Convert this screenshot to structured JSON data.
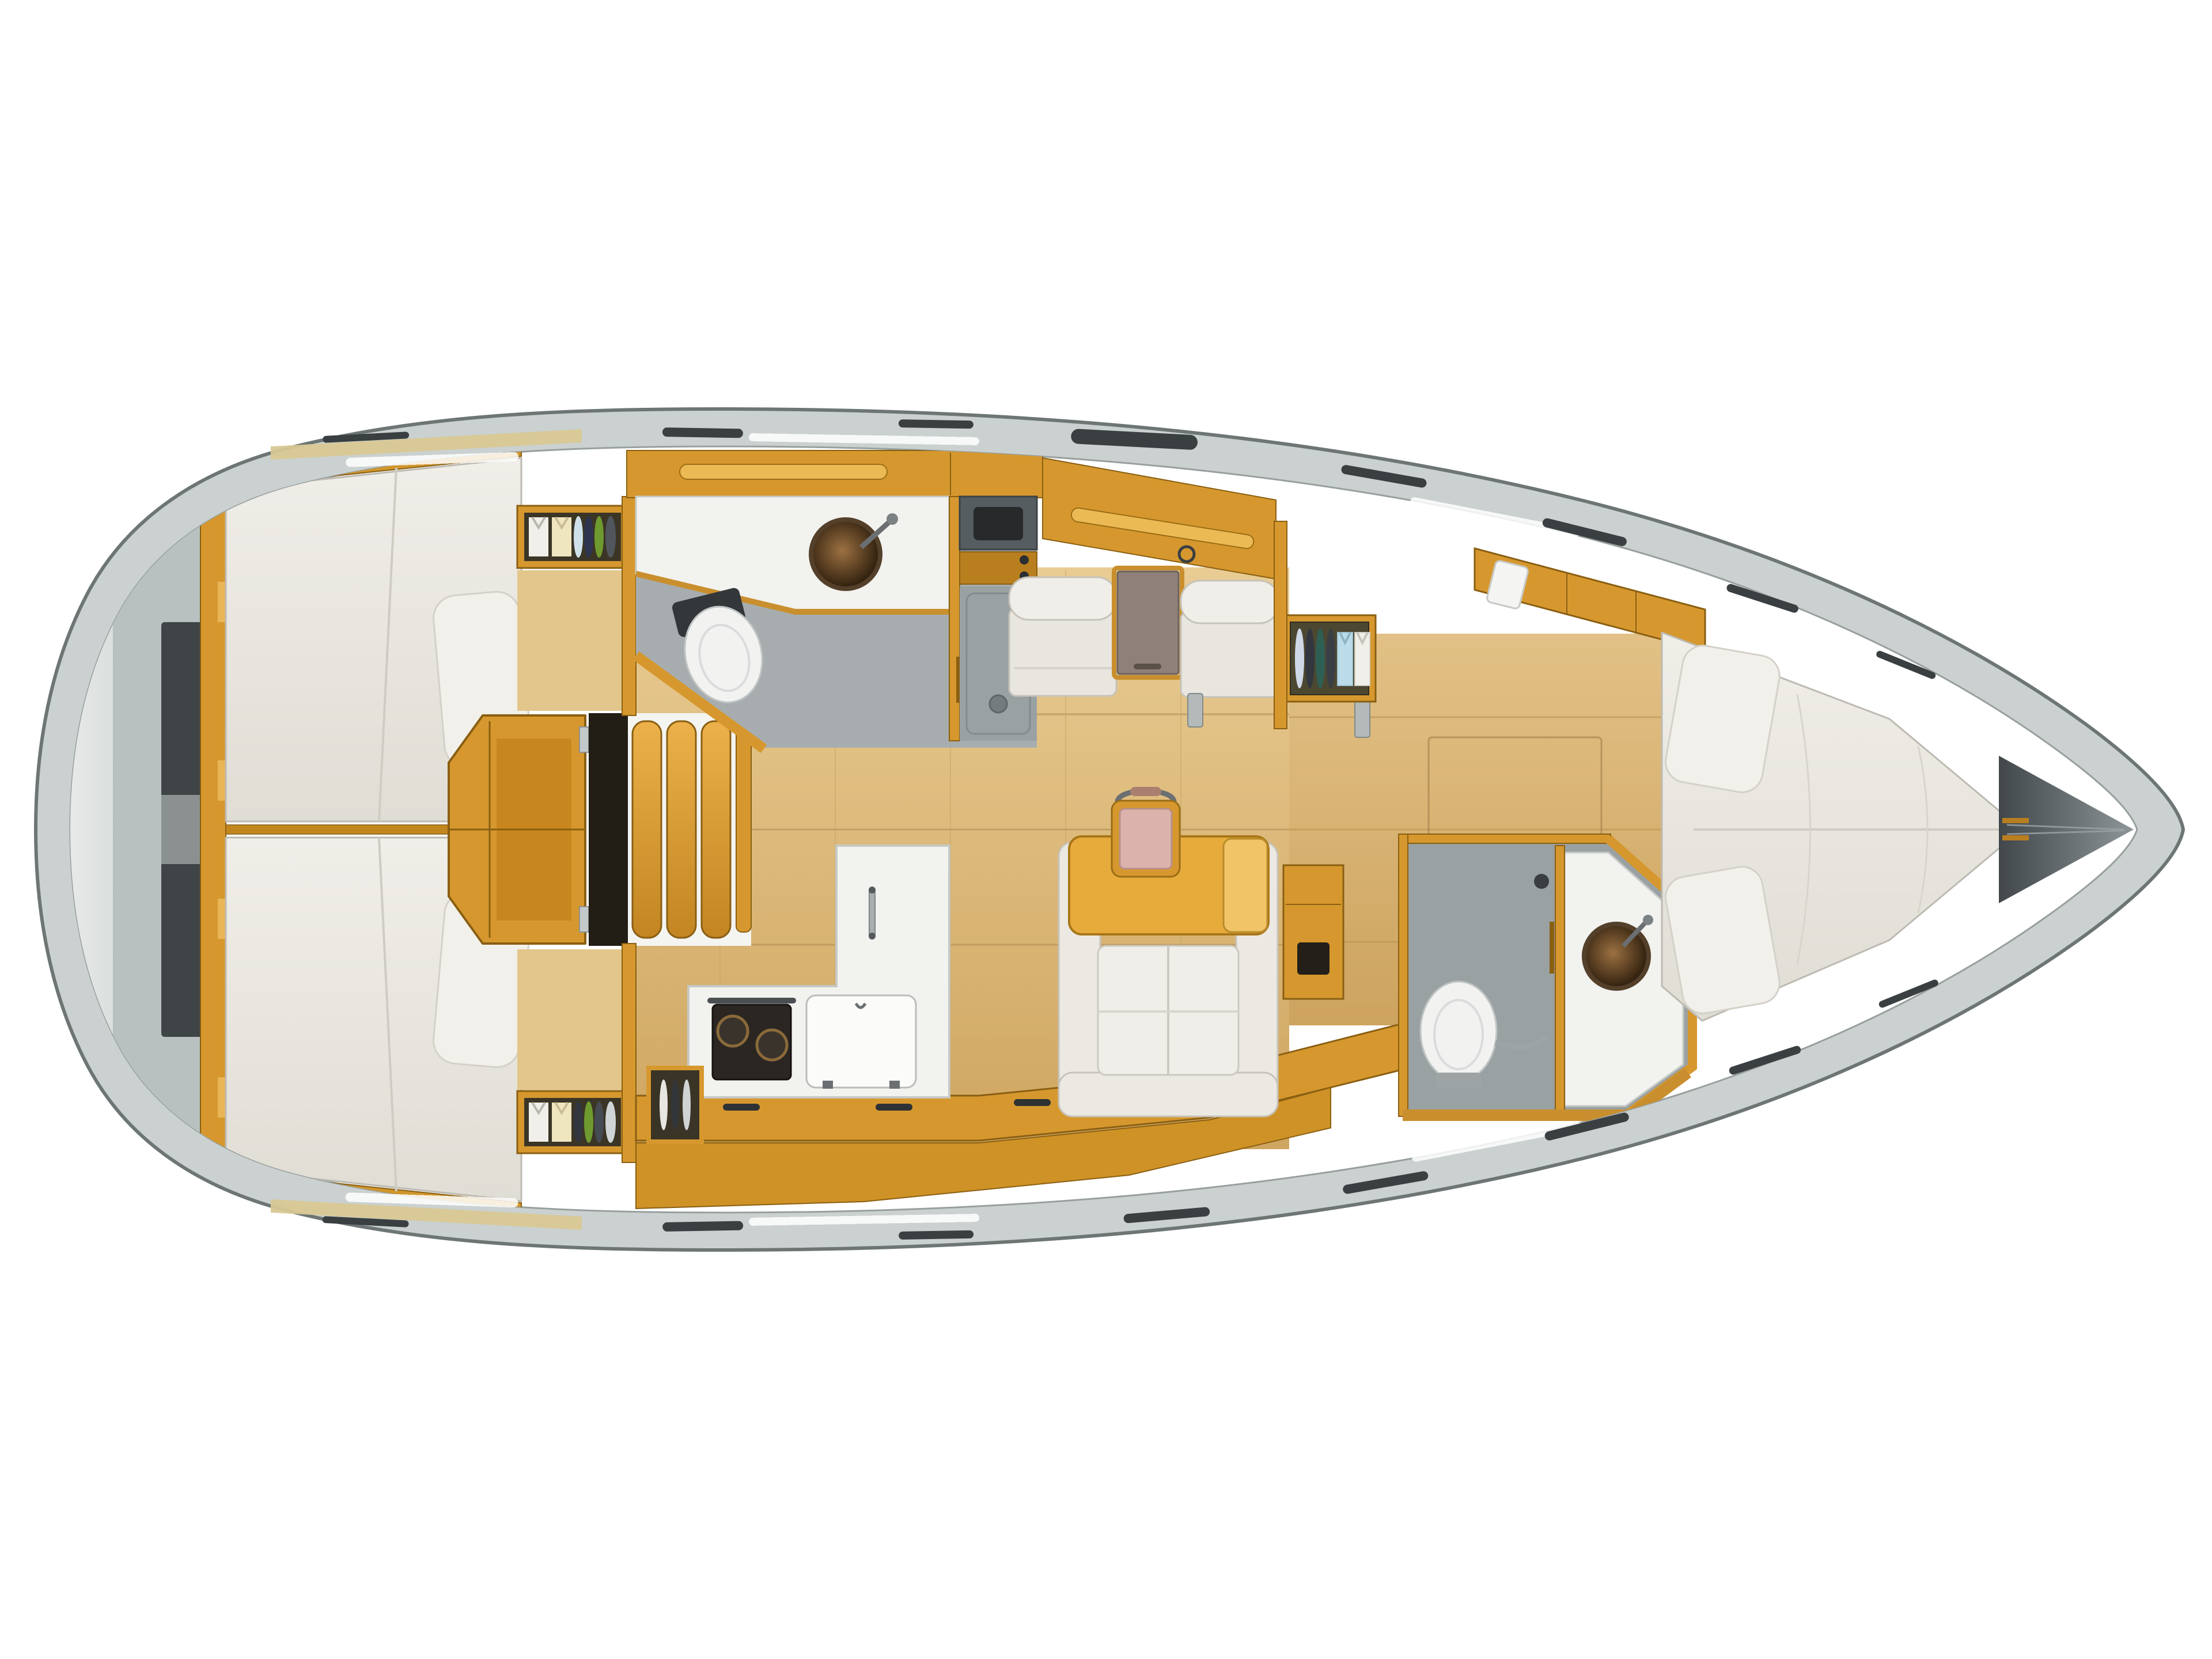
{
  "meta": {
    "title": "sailboat-interior-floor-plan",
    "view": "top-down-3d-render",
    "visible_text": "none"
  },
  "colors": {
    "background": "#ffffff",
    "hull_outline": "#6d7575",
    "deck_band": "#cbd1d0",
    "stern_gray_light": "#eff1f0",
    "stern_gray_dark": "#3f4447",
    "wood_main": "#d6982e",
    "wood_dark": "#b97f1f",
    "wood_light": "#ecba55",
    "wood_edge": "#8a5f12",
    "floor_tan": "#dcba7e",
    "floor_line": "#b3925a",
    "upholstery_white": "#eae7e1",
    "upholstery_border": "#c6c3bb",
    "pillow_white": "#f2f0ea",
    "counter_white": "#f2f2ef",
    "shower_gray": "#9aa1a2",
    "sink_bronze": "#5a3f22",
    "fixture_dark": "#2c2f31",
    "chart_table_taupe": "#8f8179",
    "pink_cushion": "#dcb3ac",
    "towel_blue": "#bcdcea",
    "towel_cream": "#efe6c0",
    "plate_green": "#6f9a2f",
    "plate_navy": "#2e3450",
    "plate_teal": "#2e5f55",
    "anchor_locker_dark": "#41474a"
  },
  "rooms": {
    "stern_deck": {
      "label": "stern-transom-deck"
    },
    "aft_cabin_port": {
      "label": "aft-cabin-port-double-berth"
    },
    "aft_cabin_starboard": {
      "label": "aft-cabin-starboard-double-berth"
    },
    "companionway": {
      "label": "companionway-steps-and-engine-box"
    },
    "aft_head": {
      "label": "aft-head-toilet-sink-shower"
    },
    "galley": {
      "label": "galley-stove-sink-top-load-fridge"
    },
    "salon": {
      "label": "salon-settees-chart-table-dinette"
    },
    "fwd_head": {
      "label": "forward-head-toilet-shower-sink"
    },
    "fwd_cabin": {
      "label": "forward-v-berth-cabin"
    },
    "bow": {
      "label": "bow-anchor-locker"
    }
  },
  "items": {
    "berths": [
      "aft-port-double",
      "aft-starboard-double",
      "forward-v-berth"
    ],
    "pillows": 4,
    "toilets": 2,
    "round_bronze_sinks": 2,
    "stove_burners": 2,
    "companionway_steps": 3,
    "stowed_towels": 6,
    "stowed_plates": 11,
    "salon_armchairs": 2,
    "dinette_table_leaves": 1,
    "folding_chair_pink": 1
  }
}
